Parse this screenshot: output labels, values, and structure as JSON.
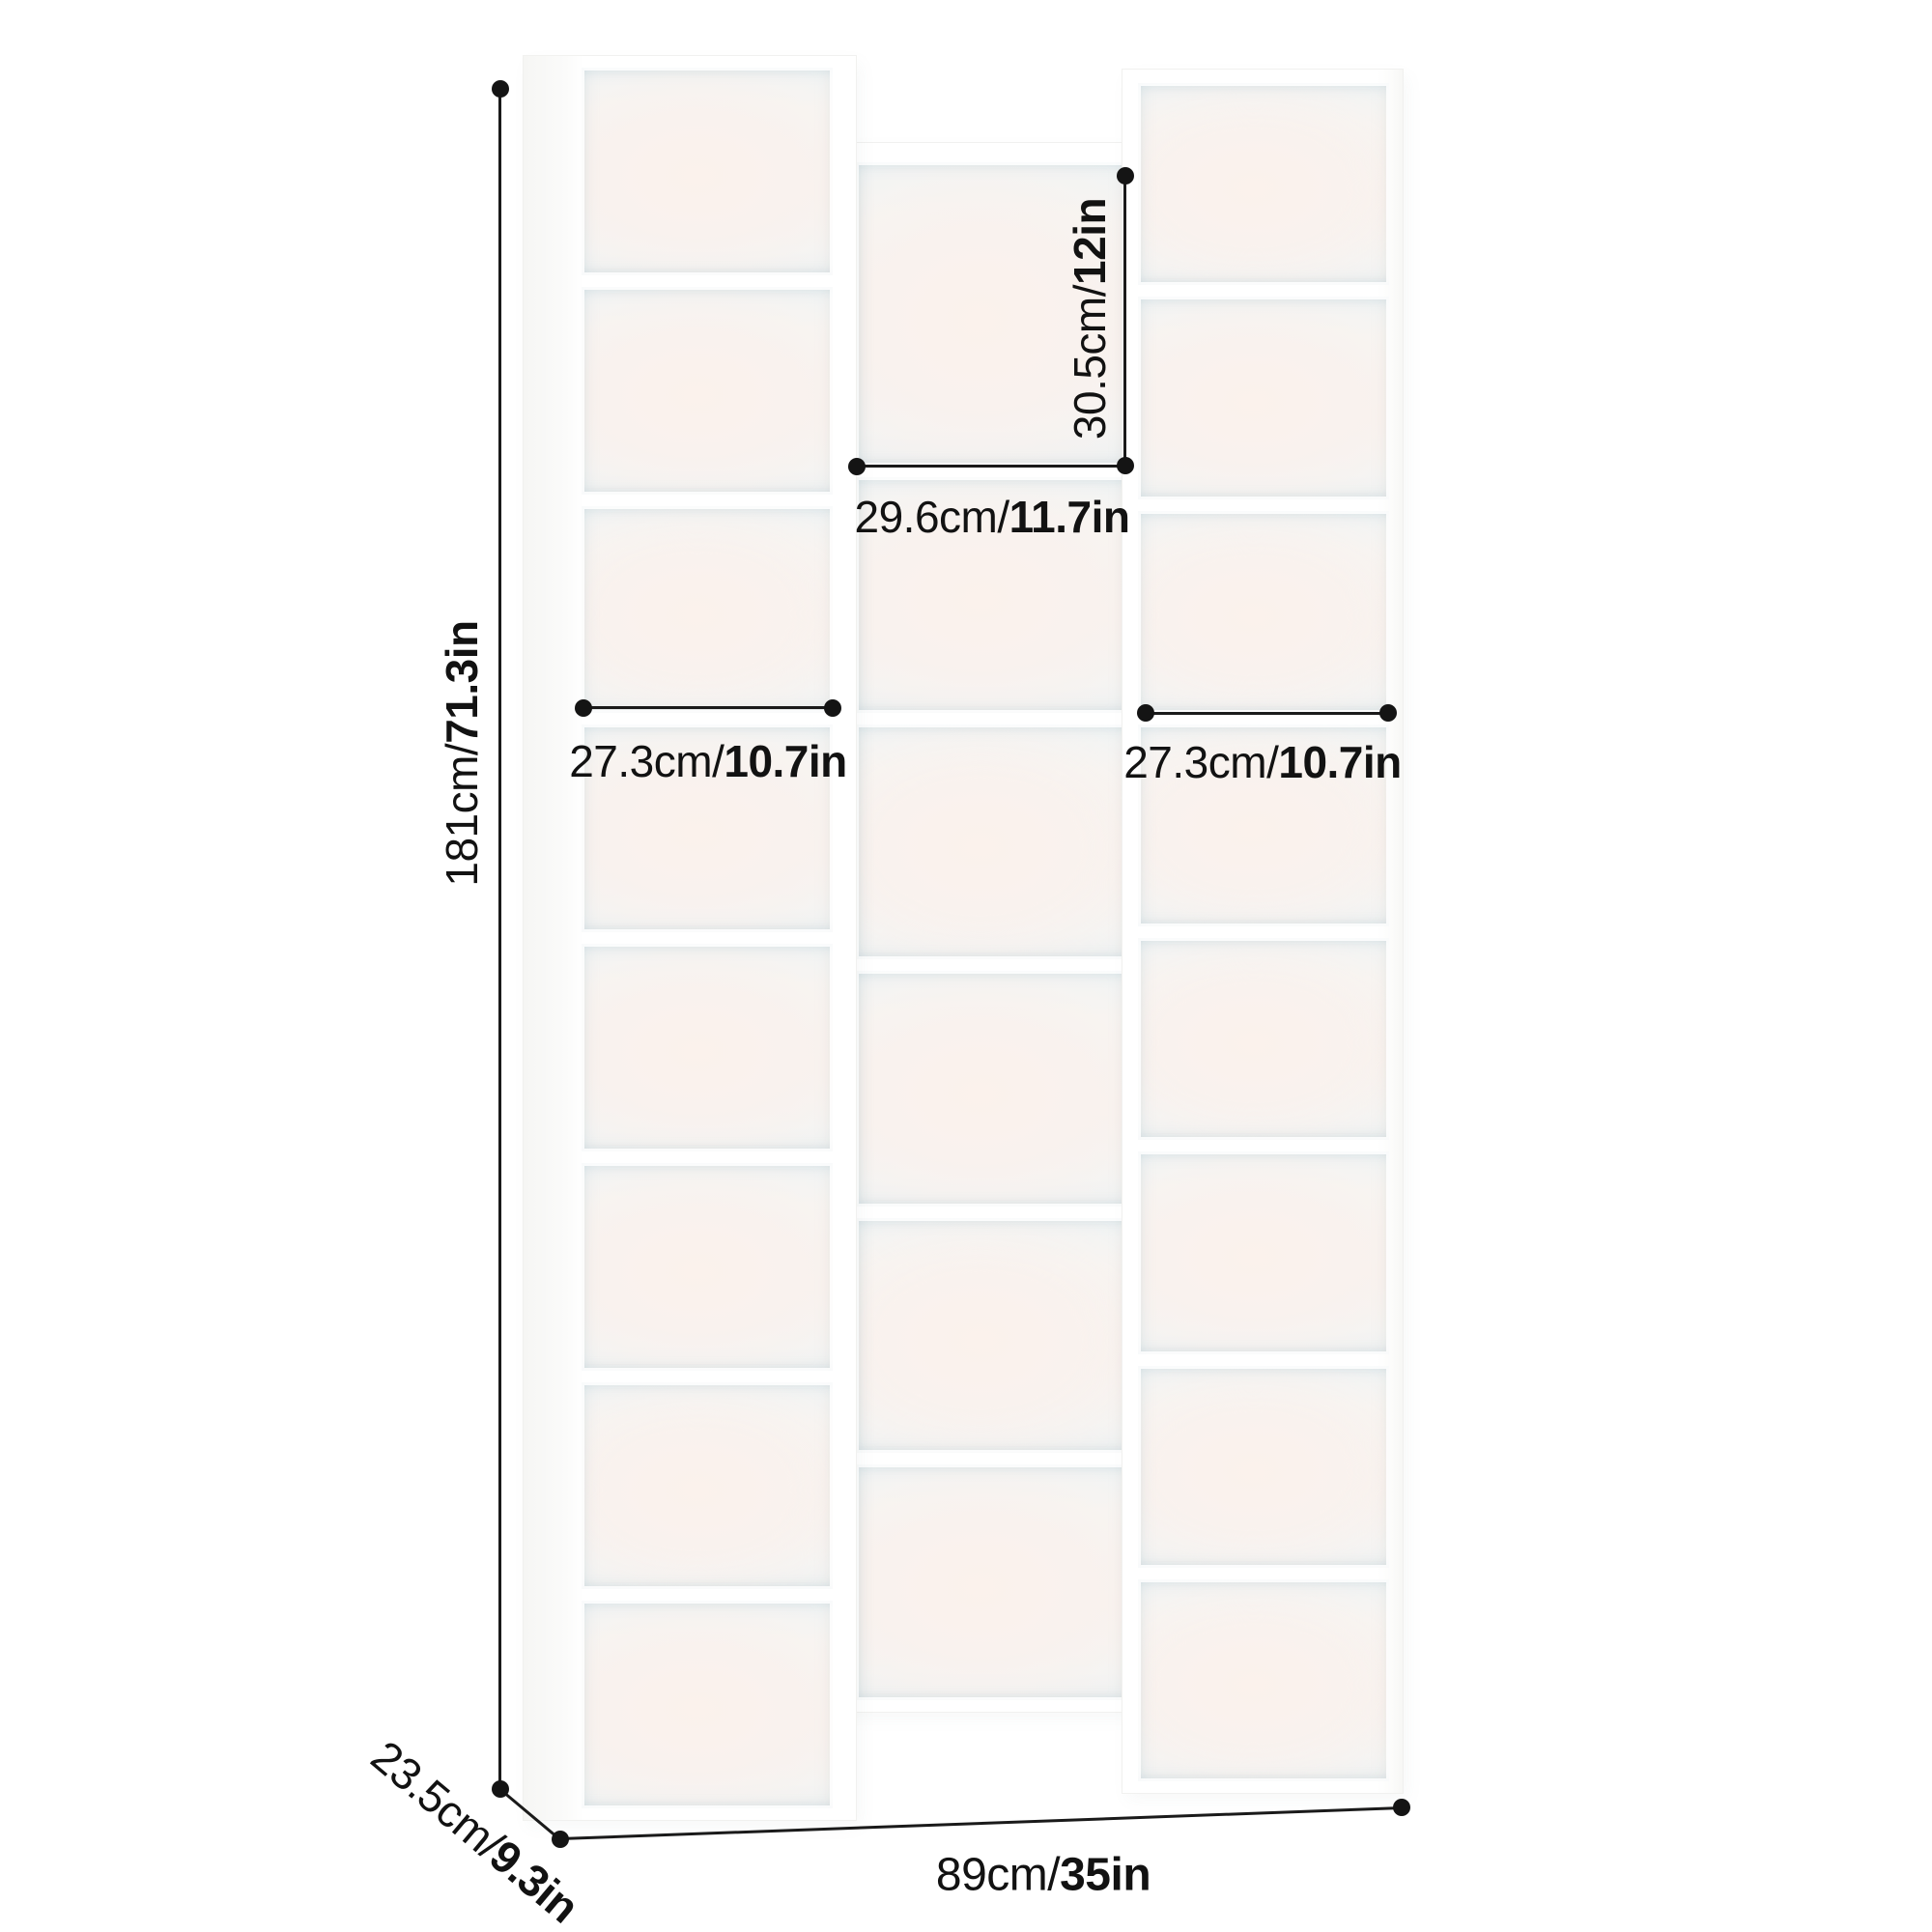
{
  "diagram": {
    "dimensions": {
      "height": {
        "part1": "181cm/",
        "part2": "71.3in"
      },
      "depth": {
        "part1": "23.5cm/",
        "part2": "9.3in"
      },
      "width": {
        "part1": "89cm/",
        "part2": "35in"
      },
      "middle_cubby_height": {
        "part1": "30.5cm/",
        "part2": "12in"
      },
      "middle_column_width": {
        "part1": "29.6cm/",
        "part2": "11.7in"
      },
      "left_column_width": {
        "part1": "27.3cm/",
        "part2": "10.7in"
      },
      "right_column_width": {
        "part1": "27.3cm/",
        "part2": "10.7in"
      }
    },
    "colors": {
      "text": "#121212",
      "line": "#1a1a1a",
      "frame": "#ffffff",
      "interior_warm": "#f9f2ee",
      "interior_cool": "#eef4f6"
    }
  }
}
